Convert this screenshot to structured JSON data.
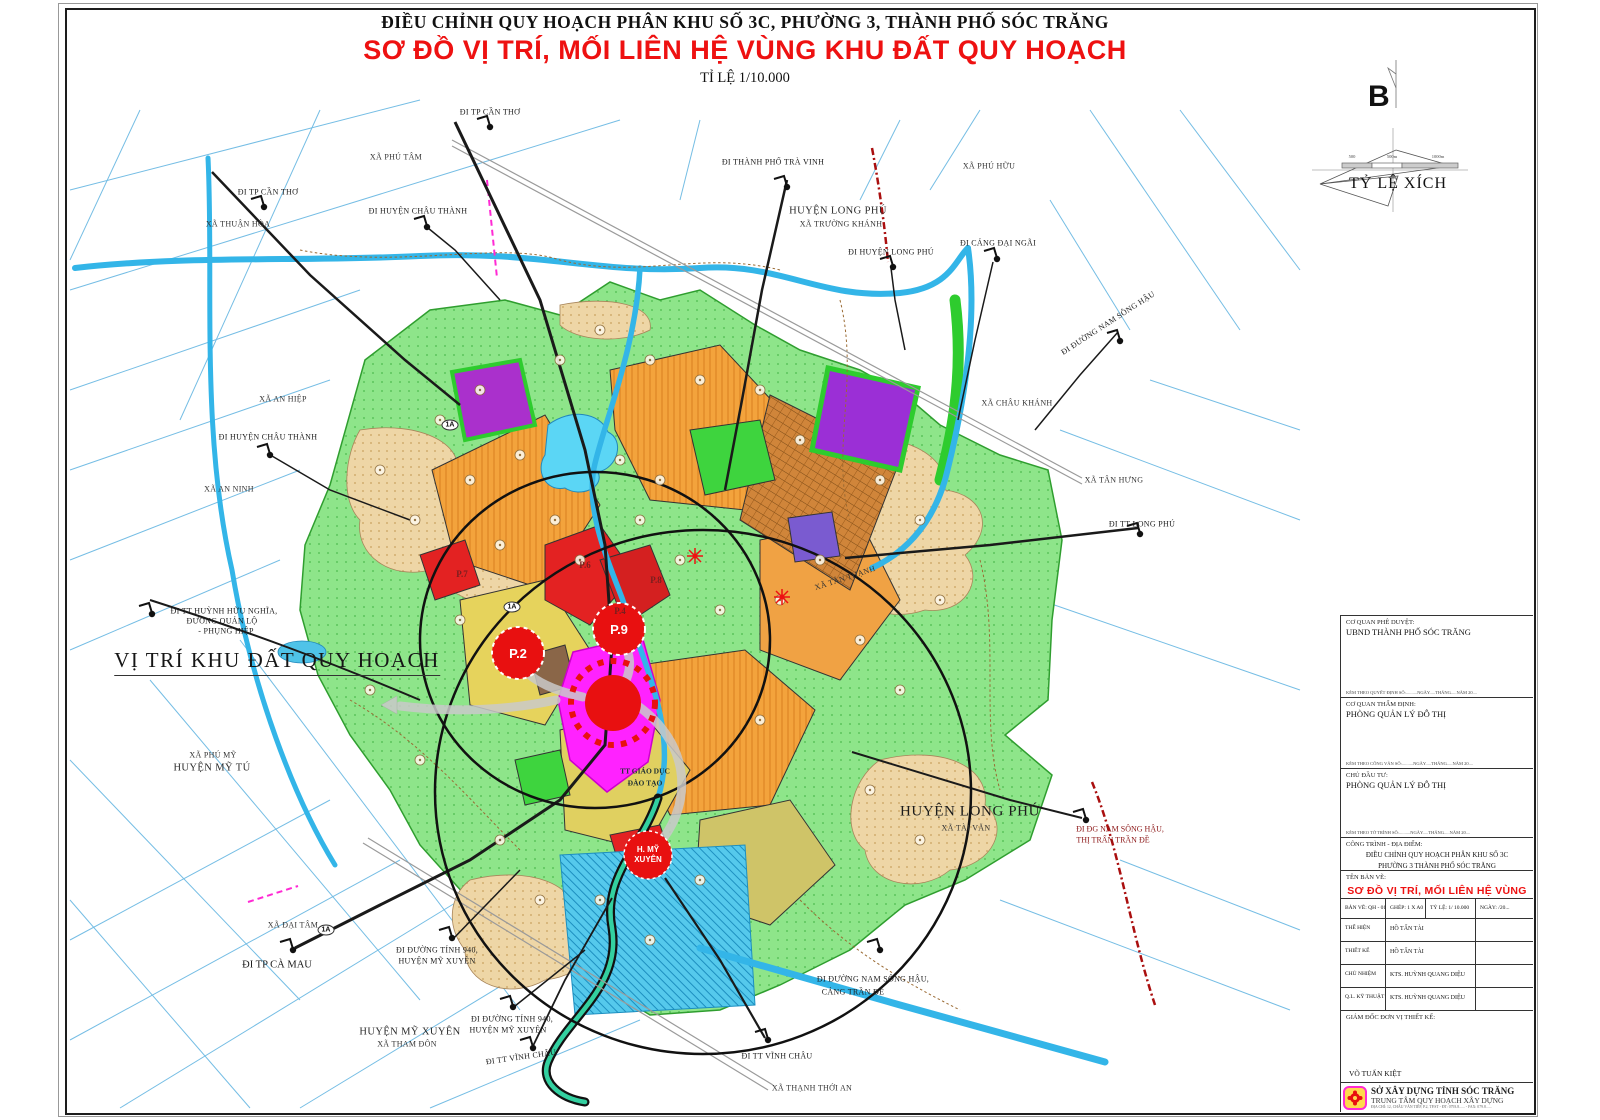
{
  "page": {
    "title_line1": "ĐIỀU CHỈNH QUY HOẠCH PHÂN KHU SỐ 3C, PHƯỜNG 3, THÀNH PHỐ SÓC TRĂNG",
    "title_line2": "SƠ ĐỒ VỊ TRÍ, MỐI LIÊN HỆ VÙNG KHU ĐẤT QUY HOẠCH",
    "title_line3": "TỈ LỆ 1/10.000"
  },
  "colors": {
    "title_red": "#ee1111",
    "map_green": "#8ee58a",
    "map_orange": "#f3a33c",
    "map_magenta": "#ff22ff",
    "map_purple": "#9b2fd6",
    "canal_blue": "#33b5e8",
    "marker_red": "#e81010"
  },
  "compass": {
    "north_label": "B",
    "scale_caption": "TỶ LỆ XÍCH",
    "ticks": [
      "500",
      "500m",
      "1000m"
    ]
  },
  "map": {
    "big_label": "VỊ TRÍ KHU ĐẤT QUY HOẠCH",
    "markers": {
      "p2": "P.2",
      "p9": "P.9",
      "hmx1": "H. MỸ",
      "hmx2": "XUYÊN"
    },
    "labels": [
      {
        "name": "route-di-tp-can-tho-top",
        "text": "ĐI TP CẦN THƠ",
        "x": 490,
        "y": 112,
        "cls": "route"
      },
      {
        "name": "place-xa-phu-tam",
        "text": "XÃ PHÚ TÂM",
        "x": 396,
        "y": 157,
        "cls": "place"
      },
      {
        "name": "route-di-huyen-chau-thanh-top",
        "text": "ĐI HUYỆN CHÂU THÀNH",
        "x": 418,
        "y": 211,
        "cls": "route"
      },
      {
        "name": "place-xa-thuan-hoa",
        "text": "XÃ THUẬN HÒA",
        "x": 238,
        "y": 224,
        "cls": "place"
      },
      {
        "name": "route-di-tp-can-tho-left",
        "text": "ĐI TP CẦN THƠ",
        "x": 268,
        "y": 192,
        "cls": "route"
      },
      {
        "name": "route-di-thanh-pho-tra-vinh",
        "text": "ĐI THÀNH PHỐ TRÀ VINH",
        "x": 773,
        "y": 162,
        "cls": "route"
      },
      {
        "name": "place-huyen-long-phu-top",
        "text": "HUYỆN LONG PHÚ",
        "x": 838,
        "y": 211,
        "cls": "place-lg"
      },
      {
        "name": "place-xa-truong-khanh",
        "text": "XÃ TRƯỜNG KHÁNH",
        "x": 841,
        "y": 224,
        "cls": "place"
      },
      {
        "name": "place-xa-phu-huu",
        "text": "XÃ PHÚ HỮU",
        "x": 989,
        "y": 166,
        "cls": "place"
      },
      {
        "name": "route-di-huyen-long-phu",
        "text": "ĐI HUYỆN LONG PHÚ",
        "x": 891,
        "y": 252,
        "cls": "route"
      },
      {
        "name": "route-di-cang-dai-ngai",
        "text": "ĐI CẢNG ĐẠI NGÃI",
        "x": 998,
        "y": 243,
        "cls": "route"
      },
      {
        "name": "route-di-duong-nam-song-hau-ne",
        "text": "ĐI ĐƯỜNG NAM SÔNG HẬU",
        "x": 1108,
        "y": 323,
        "cls": "route",
        "rot": -33
      },
      {
        "name": "place-xa-chau-khanh",
        "text": "XÃ CHÂU KHÁNH",
        "x": 1017,
        "y": 403,
        "cls": "place"
      },
      {
        "name": "place-xa-tan-hung",
        "text": "XÃ TÂN HƯNG",
        "x": 1114,
        "y": 480,
        "cls": "place"
      },
      {
        "name": "route-di-tt-long-phu",
        "text": "ĐI TT LONG PHÚ",
        "x": 1142,
        "y": 524,
        "cls": "route"
      },
      {
        "name": "place-xa-tan-thanh",
        "text": "XÃ TÂN THẠNH",
        "x": 845,
        "y": 578,
        "cls": "place",
        "rot": -18
      },
      {
        "name": "place-huyen-long-phu-se",
        "text": "HUYỆN LONG PHÚ",
        "x": 970,
        "y": 812,
        "cls": "place-xl"
      },
      {
        "name": "place-xa-tai-van",
        "text": "XÃ TÀI VĂN",
        "x": 966,
        "y": 828,
        "cls": "place"
      },
      {
        "name": "route-di-dg-nam-song-hau",
        "text": "ĐI ĐG NAM SÔNG HẬU,",
        "x": 1120,
        "y": 829,
        "cls": "route-red"
      },
      {
        "name": "route-thi-tran-tran-de",
        "text": "THỊ TRẤN TRẦN ĐỀ",
        "x": 1113,
        "y": 840,
        "cls": "route-red"
      },
      {
        "name": "route-di-duong-nam-song-hau-s",
        "text": "ĐI ĐƯỜNG NAM SÔNG HẬU,",
        "x": 873,
        "y": 979,
        "cls": "route"
      },
      {
        "name": "route-cang-tran-de",
        "text": "CẢNG TRẦN ĐỀ",
        "x": 853,
        "y": 992,
        "cls": "route"
      },
      {
        "name": "route-di-tt-vinh-chau-se",
        "text": "ĐI TT VĨNH CHÂU",
        "x": 777,
        "y": 1056,
        "cls": "route"
      },
      {
        "name": "place-xa-thanh-thoi-an",
        "text": "XÃ THẠNH THỚI AN",
        "x": 812,
        "y": 1088,
        "cls": "place"
      },
      {
        "name": "route-di-tt-vinh-chau-s",
        "text": "ĐI TT VĨNH CHÂU",
        "x": 521,
        "y": 1057,
        "cls": "route",
        "rot": -8
      },
      {
        "name": "route-di-duong-tinh-940-a",
        "text": "ĐI ĐƯỜNG TỈNH 940,",
        "x": 437,
        "y": 950,
        "cls": "route"
      },
      {
        "name": "route-huyen-my-xuyen-a",
        "text": "HUYỆN MỸ XUYÊN",
        "x": 437,
        "y": 961,
        "cls": "route"
      },
      {
        "name": "route-di-duong-tinh-940-b",
        "text": "ĐI ĐƯỜNG TỈNH 940,",
        "x": 512,
        "y": 1019,
        "cls": "route"
      },
      {
        "name": "route-huyen-my-xuyen-b",
        "text": "HUYỆN MỸ XUYÊN",
        "x": 508,
        "y": 1030,
        "cls": "route"
      },
      {
        "name": "place-huyen-my-xuyen",
        "text": "HUYỆN MỸ XUYÊN",
        "x": 410,
        "y": 1032,
        "cls": "place-lg"
      },
      {
        "name": "place-xa-tham-don",
        "text": "XÃ THAM ĐÔN",
        "x": 407,
        "y": 1044,
        "cls": "place"
      },
      {
        "name": "route-di-tp-ca-mau",
        "text": "ĐI TP CÀ MAU",
        "x": 277,
        "y": 965,
        "cls": "route-lg"
      },
      {
        "name": "place-xa-dai-tam",
        "text": "XÃ ĐẠI TÂM",
        "x": 293,
        "y": 925,
        "cls": "place"
      },
      {
        "name": "route-di-tt-huynh-huu-nghia",
        "text": "ĐI TT HUỲNH HỮU NGHĨA,",
        "x": 224,
        "y": 611,
        "cls": "route"
      },
      {
        "name": "route-duong-quan-lo",
        "text": "ĐƯỜNG QUẢN LỘ",
        "x": 222,
        "y": 621,
        "cls": "route"
      },
      {
        "name": "route-phung-hiep",
        "text": "- PHỤNG HIỆP",
        "x": 226,
        "y": 631,
        "cls": "route"
      },
      {
        "name": "place-xa-phu-my",
        "text": "XÃ PHÚ MỸ",
        "x": 213,
        "y": 755,
        "cls": "place"
      },
      {
        "name": "place-huyen-my-tu",
        "text": "HUYỆN MỸ TÚ",
        "x": 212,
        "y": 768,
        "cls": "place-lg"
      },
      {
        "name": "place-xa-an-hiep",
        "text": "XÃ AN HIỆP",
        "x": 283,
        "y": 399,
        "cls": "place"
      },
      {
        "name": "route-di-huyen-chau-thanh-w",
        "text": "ĐI HUYỆN CHÂU THÀNH",
        "x": 268,
        "y": 437,
        "cls": "route"
      },
      {
        "name": "place-xa-an-ninh",
        "text": "XÃ AN NINH",
        "x": 229,
        "y": 489,
        "cls": "place"
      },
      {
        "name": "zone-tt-giao-duc",
        "text": "TT GIÁO DỤC",
        "x": 645,
        "y": 771,
        "cls": "zone-label"
      },
      {
        "name": "zone-dao-tao",
        "text": "ĐÀO TẠO",
        "x": 645,
        "y": 783,
        "cls": "zone-label"
      },
      {
        "name": "zone-p4",
        "text": "P.4",
        "x": 620,
        "y": 611,
        "cls": "zone-red"
      },
      {
        "name": "zone-p6",
        "text": "P.6",
        "x": 585,
        "y": 565,
        "cls": "zone-red"
      },
      {
        "name": "zone-p7",
        "text": "P.7",
        "x": 462,
        "y": 574,
        "cls": "zone-red"
      },
      {
        "name": "zone-p8",
        "text": "P.8",
        "x": 656,
        "y": 580,
        "cls": "zone-red"
      },
      {
        "name": "badge-1a-center",
        "text": "1A",
        "x": 512,
        "y": 607,
        "cls": "badge"
      },
      {
        "name": "badge-1a-north",
        "text": "1A",
        "x": 450,
        "y": 425,
        "cls": "badge"
      },
      {
        "name": "badge-1a-south",
        "text": "1A",
        "x": 326,
        "y": 930,
        "cls": "badge"
      }
    ]
  },
  "title_block": {
    "approve_label": "CƠ QUAN PHÊ DUYỆT:",
    "approve_value": "UBND THÀNH PHỐ SÓC TRĂNG",
    "approve_note": "KÈM THEO QUYẾT ĐỊNH SỐ:..........NGÀY.....THÁNG.....NĂM 20....",
    "appraise_label": "CƠ QUAN THẨM ĐỊNH:",
    "appraise_value": "PHÒNG QUẢN LÝ ĐÔ THỊ",
    "appraise_note": "KÈM THEO CÔNG VĂN SỐ:..........NGÀY.....THÁNG.....NĂM 20....",
    "investor_label": "CHỦ ĐẦU TƯ:",
    "investor_value": "PHÒNG QUẢN LÝ ĐÔ THỊ",
    "investor_note": "KÈM THEO TỜ TRÌNH SỐ:..........NGÀY.....THÁNG.....NĂM 20....",
    "project_label": "CÔNG TRÌNH - ĐỊA ĐIỂM:",
    "project_line1": "ĐIỀU CHỈNH QUY HOẠCH PHÂN KHU SỐ 3C",
    "project_line2": "PHƯỜNG 3 THÀNH PHỐ SÓC TRĂNG",
    "drawing_label": "TÊN BẢN VẼ:",
    "drawing_title": "SƠ ĐỒ VỊ TRÍ, MỐI LIÊN HỆ VÙNG",
    "sheet": "BẢN VẼ: QH - 01/02",
    "paper": "GHÉP: 1 X A0",
    "scale": "TỶ LỆ: 1/ 10.000",
    "date": "NGÀY:    /20...",
    "rows": [
      {
        "role": "THỂ HIỆN",
        "name": "HỒ TẤN TÀI"
      },
      {
        "role": "THIẾT KẾ",
        "name": "HỒ TẤN TÀI"
      },
      {
        "role": "CHỦ NHIỆM",
        "name": "KTS. HUỲNH QUANG DIỆU"
      },
      {
        "role": "Q.L. KỸ THUẬT",
        "name": "KTS. HUỲNH QUANG DIỆU"
      }
    ],
    "director_label": "GIÁM ĐỐC ĐƠN VỊ THIẾT KẾ:",
    "director_name": "VÕ TUẤN KIỆT",
    "org_line1": "SỞ XÂY DỰNG TỈNH SÓC TRĂNG",
    "org_line2": "TRUNG TÂM QUY HOẠCH XÂY DỰNG",
    "org_line3": "ĐỊA CHỈ: 12, CHÂU VĂN TIẾP, P.2, TP.ST - ĐT: 0793.8...... - FAX: 079.8......"
  }
}
